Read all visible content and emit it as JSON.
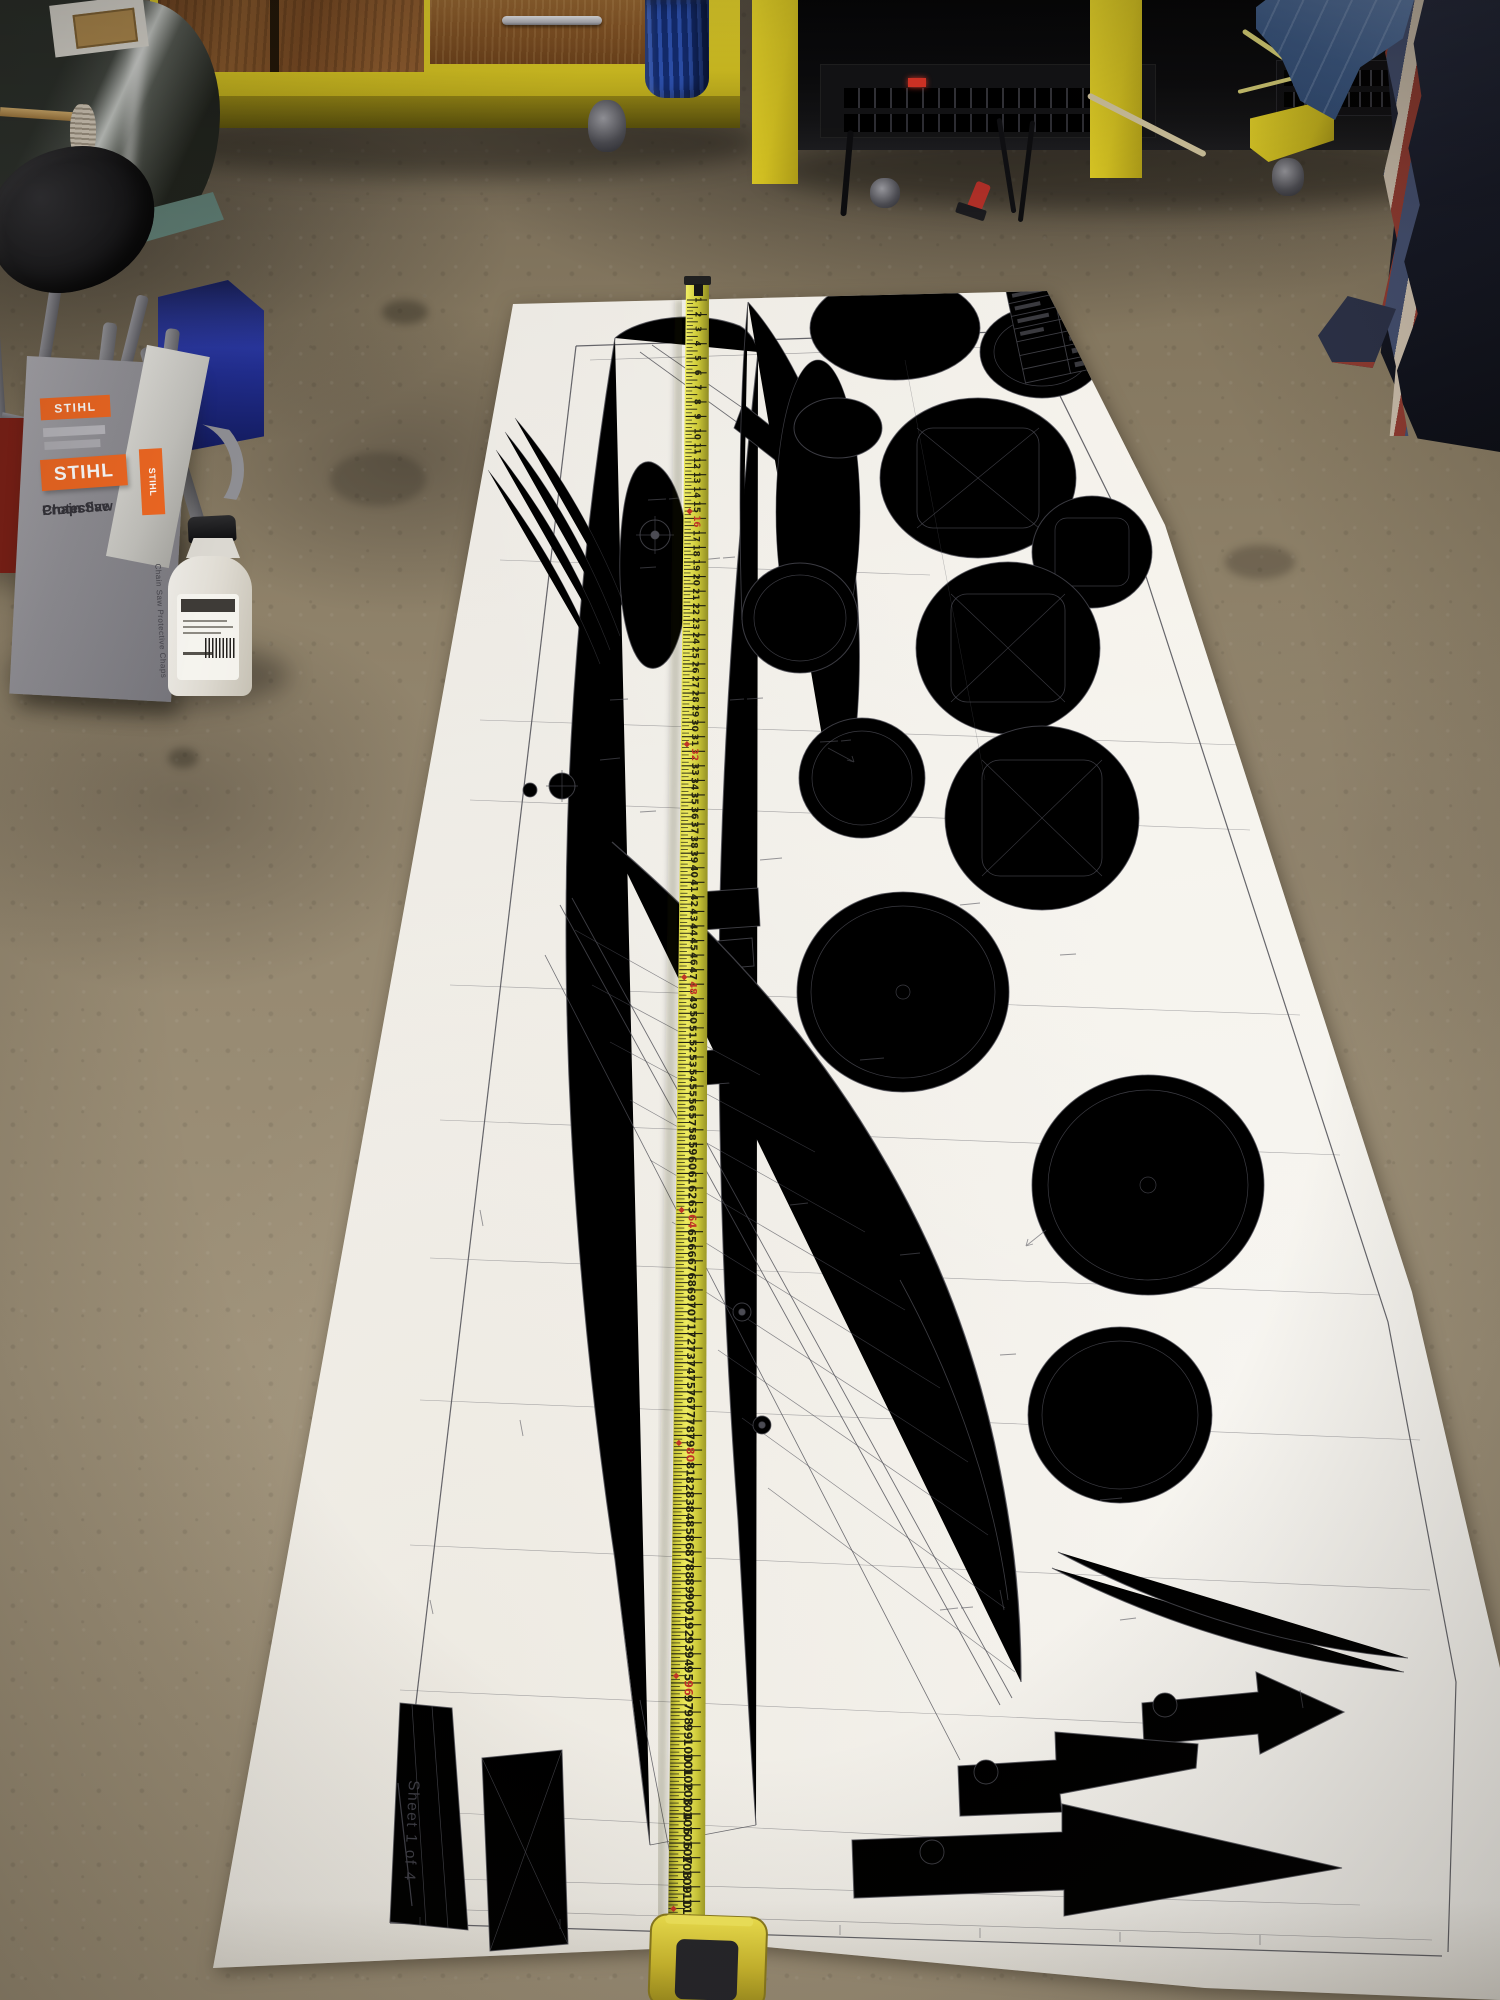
{
  "stihl_box": {
    "brand": "STIHL",
    "product": "Chain Saw Protective Chaps",
    "product_lines": [
      "Chain Saw",
      "Protective",
      "Chaps"
    ],
    "side_label": "Chain Saw Protective Chaps",
    "brand_color": "#ee6722",
    "box_color": "#908f95"
  },
  "plan_sheet": {
    "sheet_label": "Sheet 1 of 4",
    "paper_color": "#f3f1ec",
    "ink_color": "#4c4c54"
  },
  "tape_measure": {
    "unit": "inches",
    "first_visible_number": 1,
    "last_visible_number": 114,
    "number_step": 1,
    "stud_mark_interval": 16,
    "body_color": "#d6d23e",
    "case_color": "#e3c93e",
    "numeral_color": "#24240f",
    "stud_mark_color": "#c03526"
  },
  "colors": {
    "floor_base": "#8e8169",
    "cabinet_yellow": "#ddca24",
    "wood": "#8a5a2b",
    "machine_black": "#0c0c0e",
    "blanket_navy": "#161926",
    "denim_blue": "#3e5c88",
    "bag_blue": "#202c8c",
    "barrel_blue": "#3157ba"
  }
}
